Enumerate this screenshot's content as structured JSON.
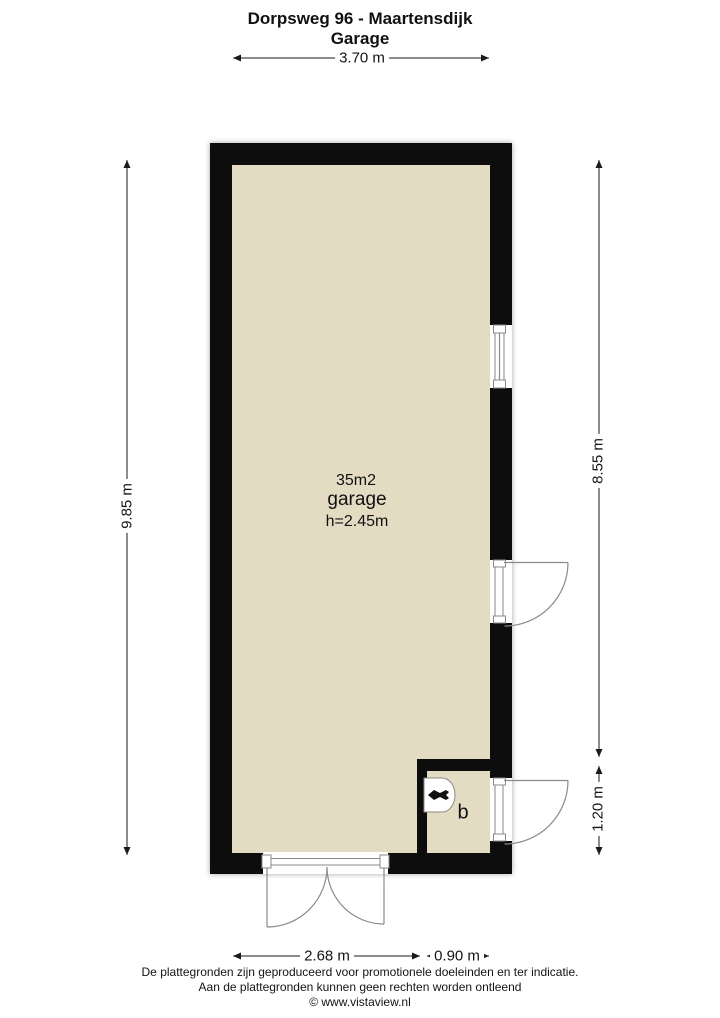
{
  "title": {
    "line1": "Dorpsweg 96 - Maartensdijk",
    "line2": "Garage"
  },
  "plan": {
    "room_area": "35m2",
    "room_name": "garage",
    "room_height": "h=2.45m",
    "sub_room_label": "b"
  },
  "dimensions": {
    "top_width": "3.70 m",
    "left_height": "9.85 m",
    "right_upper": "8.55 m",
    "right_lower": "1.20 m",
    "bottom_left": "2.68 m",
    "bottom_right": "0.90 m"
  },
  "footer": {
    "line1": "De plattegronden zijn geproduceerd voor promotionele doeleinden en ter indicatie.",
    "line2": "Aan de plattegronden kunnen geen rechten worden ontleend",
    "line3": "© www.vistaview.nl"
  },
  "colors": {
    "wall": "#0d0d0d",
    "floor": "#e3dcc3",
    "symbol_stroke": "#8a8a8a",
    "dim_line": "#1a1a1a"
  }
}
